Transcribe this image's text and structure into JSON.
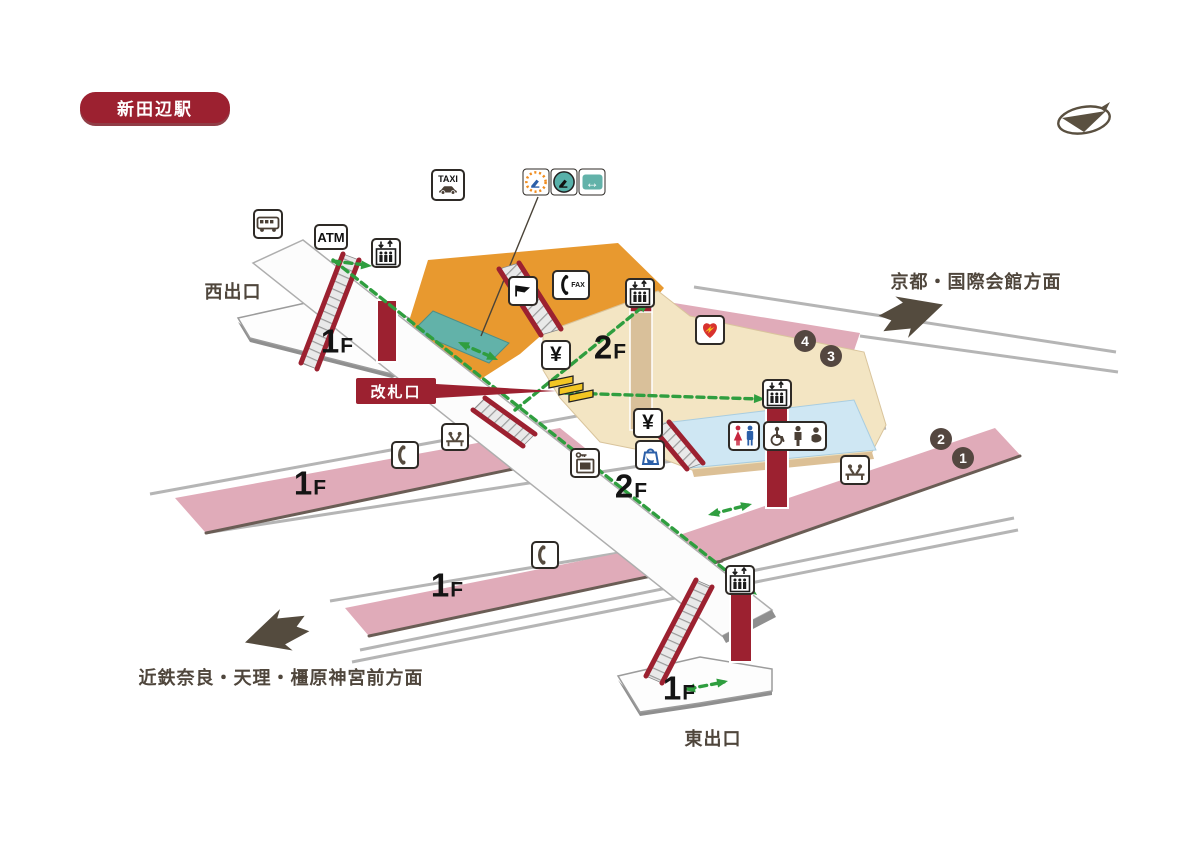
{
  "station": {
    "title": "新田辺駅"
  },
  "exits": {
    "west": "西出口",
    "east": "東出口"
  },
  "gate": {
    "label": "改札口"
  },
  "directions": {
    "kyoto": "京都・国際会館方面",
    "nara": "近鉄奈良・天理・橿原神宮前方面"
  },
  "floors": {
    "f1": {
      "num": "1",
      "suffix": "F"
    },
    "f2": {
      "num": "2",
      "suffix": "F"
    }
  },
  "platforms": {
    "badges": [
      "4",
      "3",
      "2",
      "1"
    ]
  },
  "icon_labels": {
    "atm": "ATM",
    "taxi": "TAXI",
    "fax": "FAX",
    "yen": "¥",
    "exchange": "↔"
  },
  "icons": {
    "bus": "bus-silhouette",
    "atm": "text-ATM",
    "elevator": "car-with-up-down-arrows-and-people",
    "taxi": "text-TAXI-with-car",
    "limited-express-ticket-machine": "orange-dotted-circle-blue-seat",
    "ticket-window-seat": "teal-circle-black-seat",
    "fare-adjustment": "teal-box-white-double-arrow",
    "station-office": "black-flag",
    "phone-fax": "handset-plus-FAX",
    "ticket-machine": "yen-sign",
    "aed": "red-heart-yellow-bolt",
    "restroom": "red-female-blue-male",
    "multipurpose-restroom": "wheelchair-adult-baby",
    "waiting-bench": "two-seated-figures",
    "public-phone": "handset",
    "coin-locker": "key-and-locker",
    "shop": "hand-with-bag",
    "compass": "ellipse-with-triangle-pointer"
  },
  "colors": {
    "maroon": "#9c2130",
    "pink": "#e0abb9",
    "pinkedge": "#6a5d55",
    "orange": "#e8992f",
    "teal": "#62b2a9",
    "cream": "#f3e5c3",
    "tan": "#dcc096",
    "blue": "#cfe7f3",
    "green": "#2f9e3f",
    "ink": "#4f463c",
    "rail": "#b5b5b5",
    "badgebg": "#544740",
    "yellow": "#f3c623",
    "dark": "#544b3e"
  }
}
